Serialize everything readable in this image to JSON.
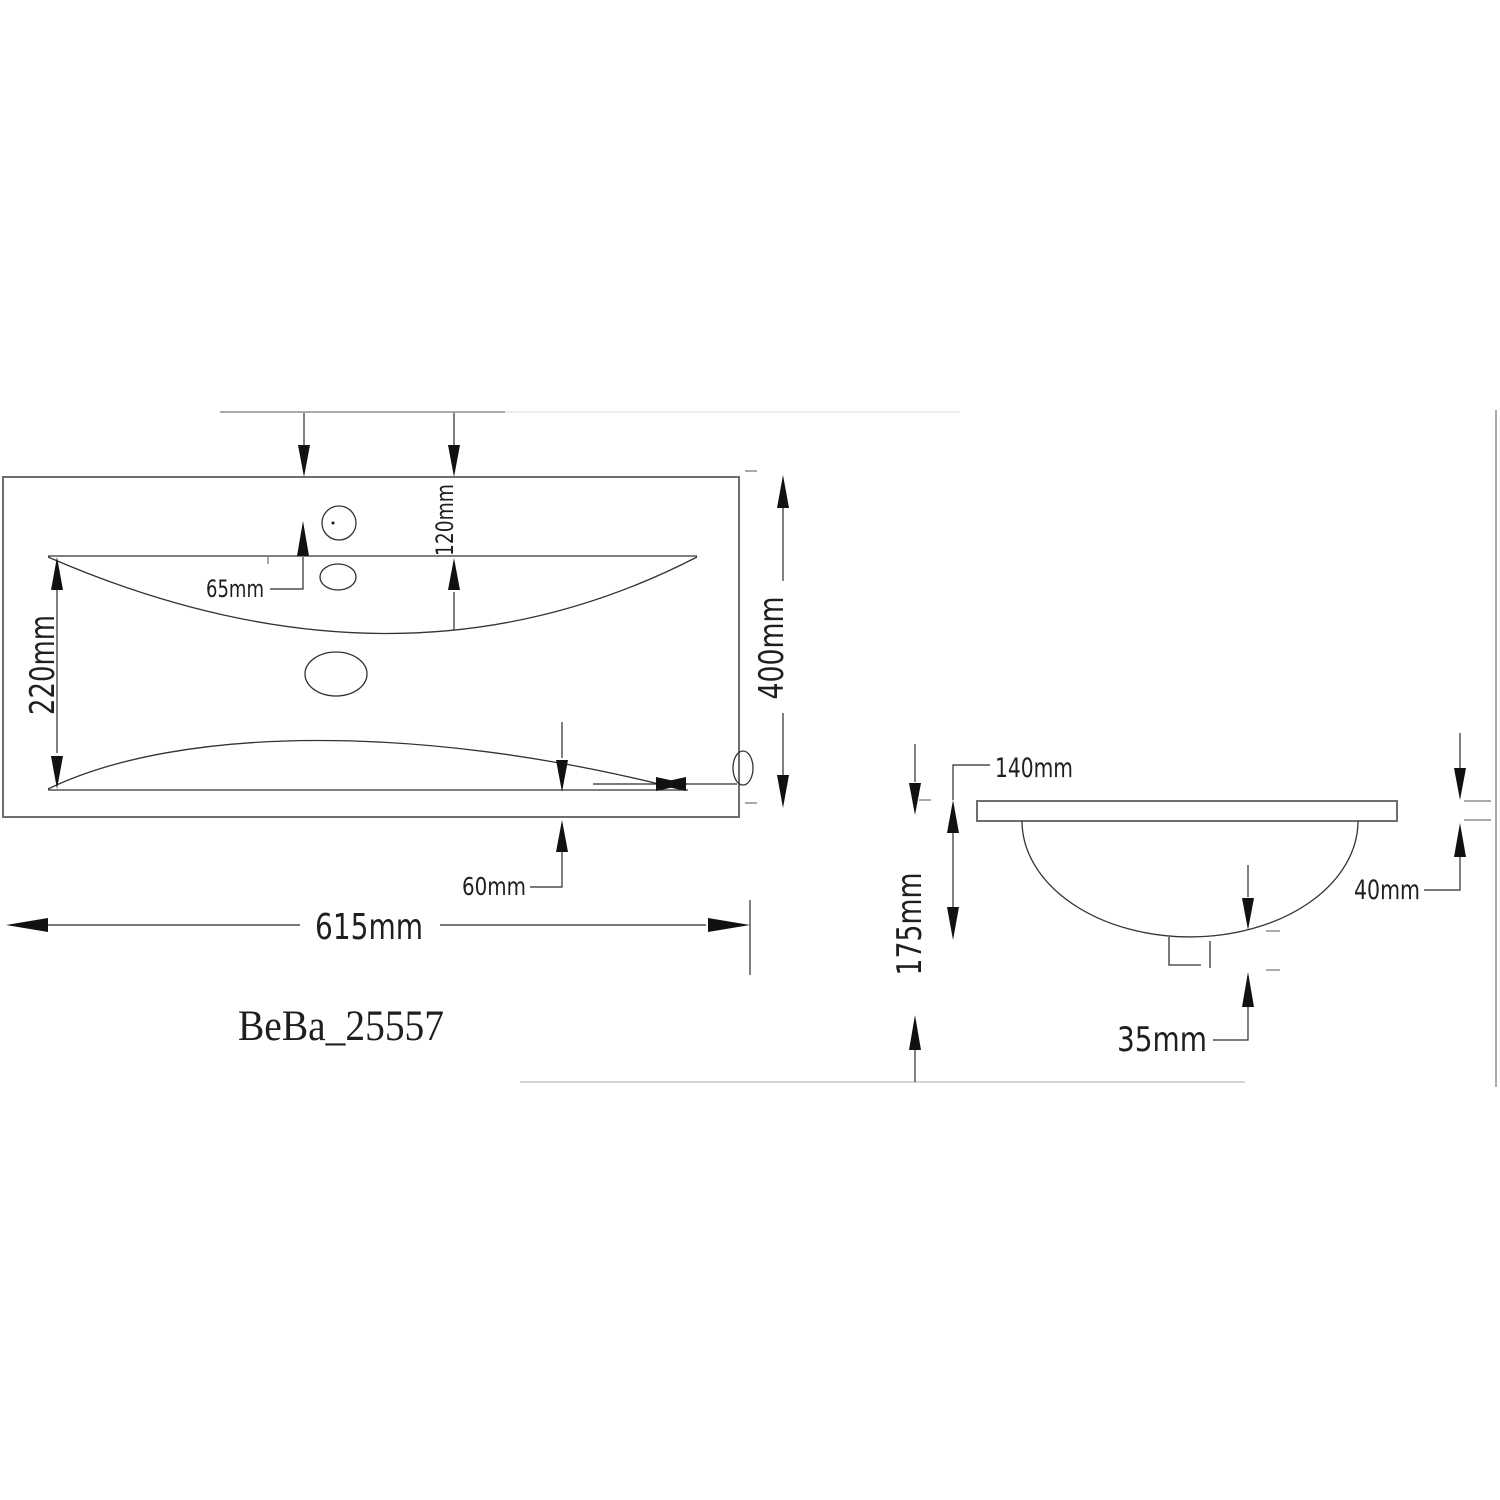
{
  "drawing": {
    "product_code": "BeBa_25557",
    "front_view": {
      "width_label": "615mm",
      "height_label": "400mm",
      "basin_height_label": "220mm",
      "tap_offset_label": "120mm",
      "hole_spacing_label": "65mm",
      "edge_offset_label": "60mm"
    },
    "side_view": {
      "rim_offset_label": "140mm",
      "total_depth_label": "175mm",
      "rim_thickness_label": "40mm",
      "drain_height_label": "35mm"
    }
  }
}
